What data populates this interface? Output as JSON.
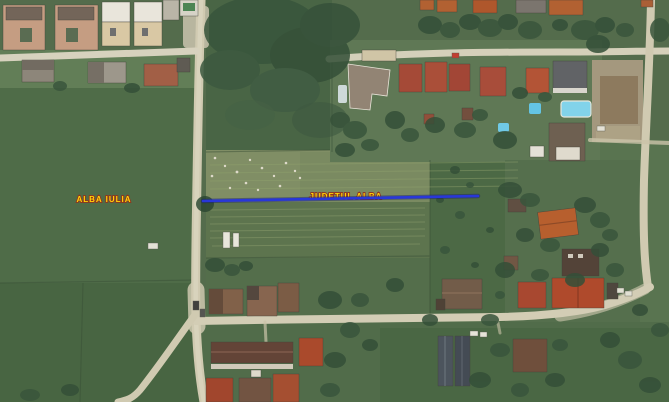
{
  "map": {
    "type": "satellite-imagery",
    "labels": {
      "city": {
        "text": "ALBA IULIA",
        "x": 104,
        "y": 202
      },
      "county": {
        "text": "JUDETUL ALBA",
        "x": 346,
        "y": 199
      }
    },
    "route": {
      "color": "#2231d8",
      "outline_color": "#0f1670",
      "x1": 203,
      "y1": 201,
      "x2": 478,
      "y2": 196
    },
    "colors": {
      "label_text": "#ffd400",
      "label_outline": "#8f2c15",
      "field_green": "#4f6847",
      "road_tan": "#cfc9af",
      "roof_red": "#a6432a",
      "roof_orange": "#b55a28",
      "roof_brown": "#6e5744",
      "pool_blue": "#7ed2ea",
      "tree_green": "#2e4a32"
    }
  }
}
